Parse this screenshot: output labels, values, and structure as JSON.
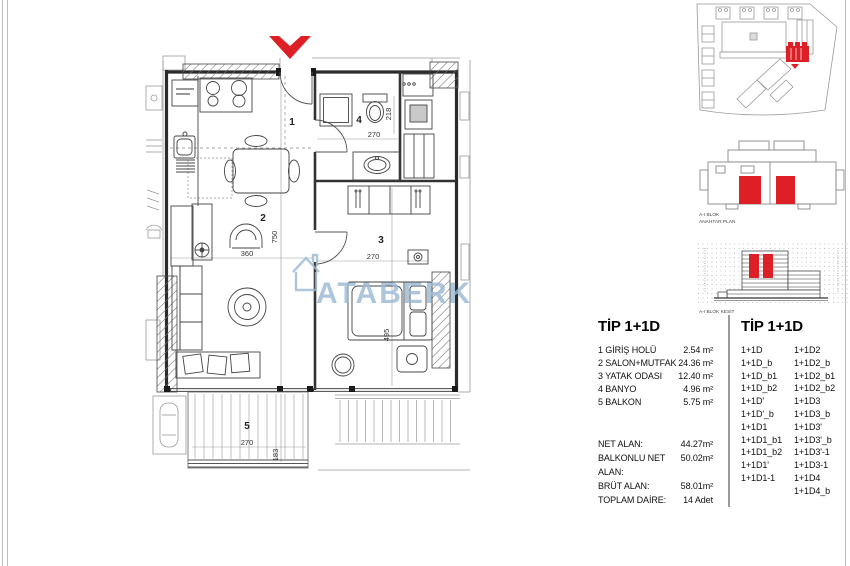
{
  "colors": {
    "accent_red": "#dd2026",
    "watermark_blue": "#9bb9d4"
  },
  "floor_plan": {
    "rooms": {
      "hall": "1",
      "salon": "2",
      "bedroom": "3",
      "bath": "4",
      "balcony": "5"
    },
    "dims": {
      "salon_h": "750",
      "salon_w": "360",
      "bedroom_w": "270",
      "bedroom_h": "495",
      "bath_w": "270",
      "bath_h": "218",
      "balcony_w": "270",
      "balcony_h": "183"
    },
    "watermark_text": "ATABERK"
  },
  "key_plan": {
    "label1": "A-I BLOK",
    "label2": "ANAHTAR PLAN"
  },
  "section": {
    "label": "A-I BLOK KESİT"
  },
  "spec": {
    "title": "TİP 1+1D",
    "rooms": [
      {
        "name": "1 GİRİŞ HOLÜ",
        "area": "2.54 m²"
      },
      {
        "name": "2 SALON+MUTFAK",
        "area": "24.36 m²"
      },
      {
        "name": "3 YATAK ODASI",
        "area": "12.40 m²"
      },
      {
        "name": "4 BANYO",
        "area": "4.96 m²"
      },
      {
        "name": "5 BALKON",
        "area": "5.75 m²"
      }
    ],
    "summary": [
      {
        "name": "NET ALAN:",
        "value": "44.27m²"
      },
      {
        "name": "BALKONLU NET ALAN:",
        "value": "50.02m²"
      },
      {
        "name": "BRÜT ALAN:",
        "value": "58.01m²"
      },
      {
        "name": "TOPLAM DAİRE:",
        "value": "14 Adet"
      }
    ]
  },
  "variants": {
    "title": "TİP 1+1D",
    "col1": [
      "1+1D",
      "1+1D_b",
      "1+1D_b1",
      "1+1D_b2",
      "1+1D'",
      "1+1D'_b",
      "1+1D1",
      "1+1D1_b1",
      "1+1D1_b2",
      "1+1D1'",
      "1+1D1-1"
    ],
    "col2": [
      "1+1D2",
      "1+1D2_b",
      "1+1D2_b1",
      "1+1D2_b2",
      "1+1D3",
      "1+1D3_b",
      "1+1D3'",
      "1+1D3'_b",
      "1+1D3'-1",
      "1+1D3-1",
      "1+1D4",
      "1+1D4_b"
    ]
  }
}
